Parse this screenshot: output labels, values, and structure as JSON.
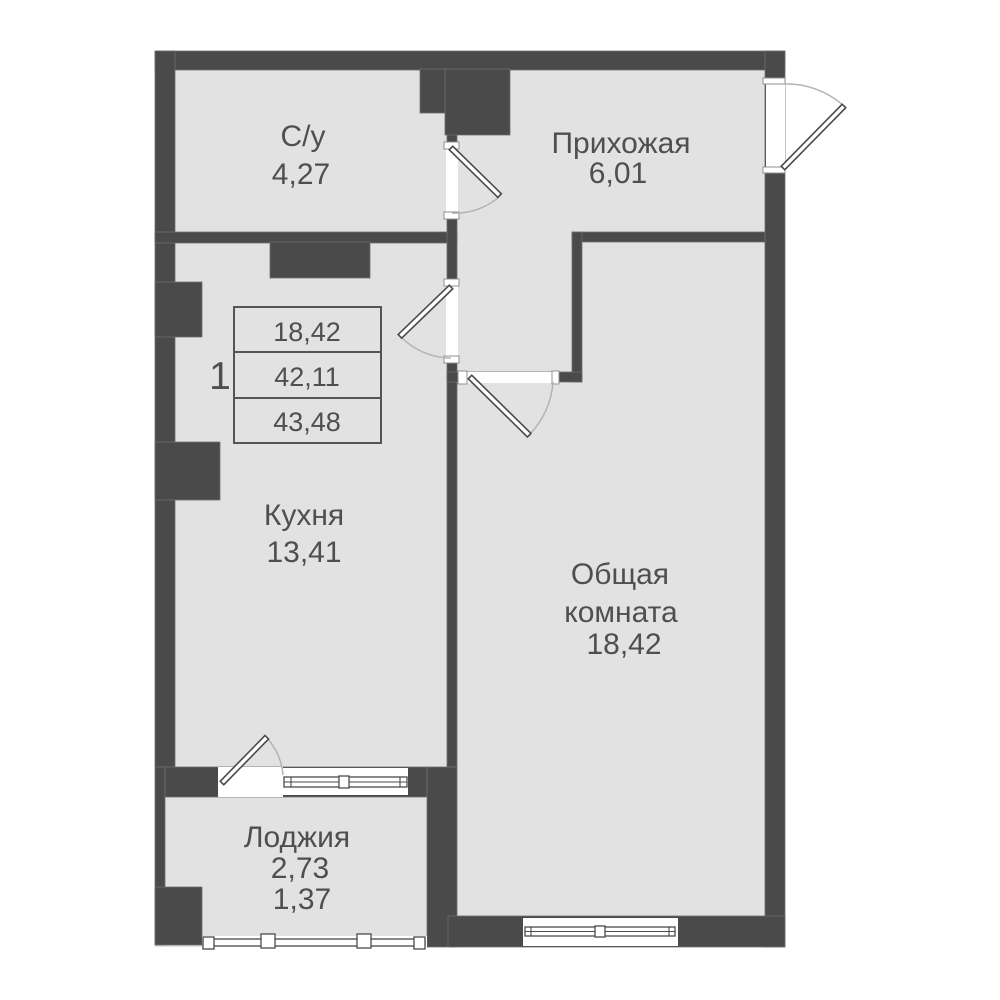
{
  "plan": {
    "type": "apartment-floor-plan",
    "language": "ru",
    "rooms": [
      {
        "id": "bathroom",
        "label": "С/у",
        "area": "4,27"
      },
      {
        "id": "hallway",
        "label": "Прихожая",
        "area": "6,01"
      },
      {
        "id": "kitchen",
        "label": "Кухня",
        "area": "13,41"
      },
      {
        "id": "living-room",
        "label": "Общая комната",
        "label_lines": [
          "Общая",
          "комната"
        ],
        "area": "18,42"
      },
      {
        "id": "loggia",
        "label": "Лоджия",
        "area": "2,73",
        "area_reduced": "1,37"
      }
    ],
    "info_table": {
      "apartment_number": "1",
      "rows": [
        "18,42",
        "42,11",
        "43,48"
      ]
    },
    "colors": {
      "wall": "#4a4a4a",
      "room_fill": "#e2e2e2",
      "background": "#ffffff",
      "text": "#4f4f4f",
      "door_arc": "#b3b3b3",
      "symbol_stroke": "#4a4a4a"
    }
  }
}
